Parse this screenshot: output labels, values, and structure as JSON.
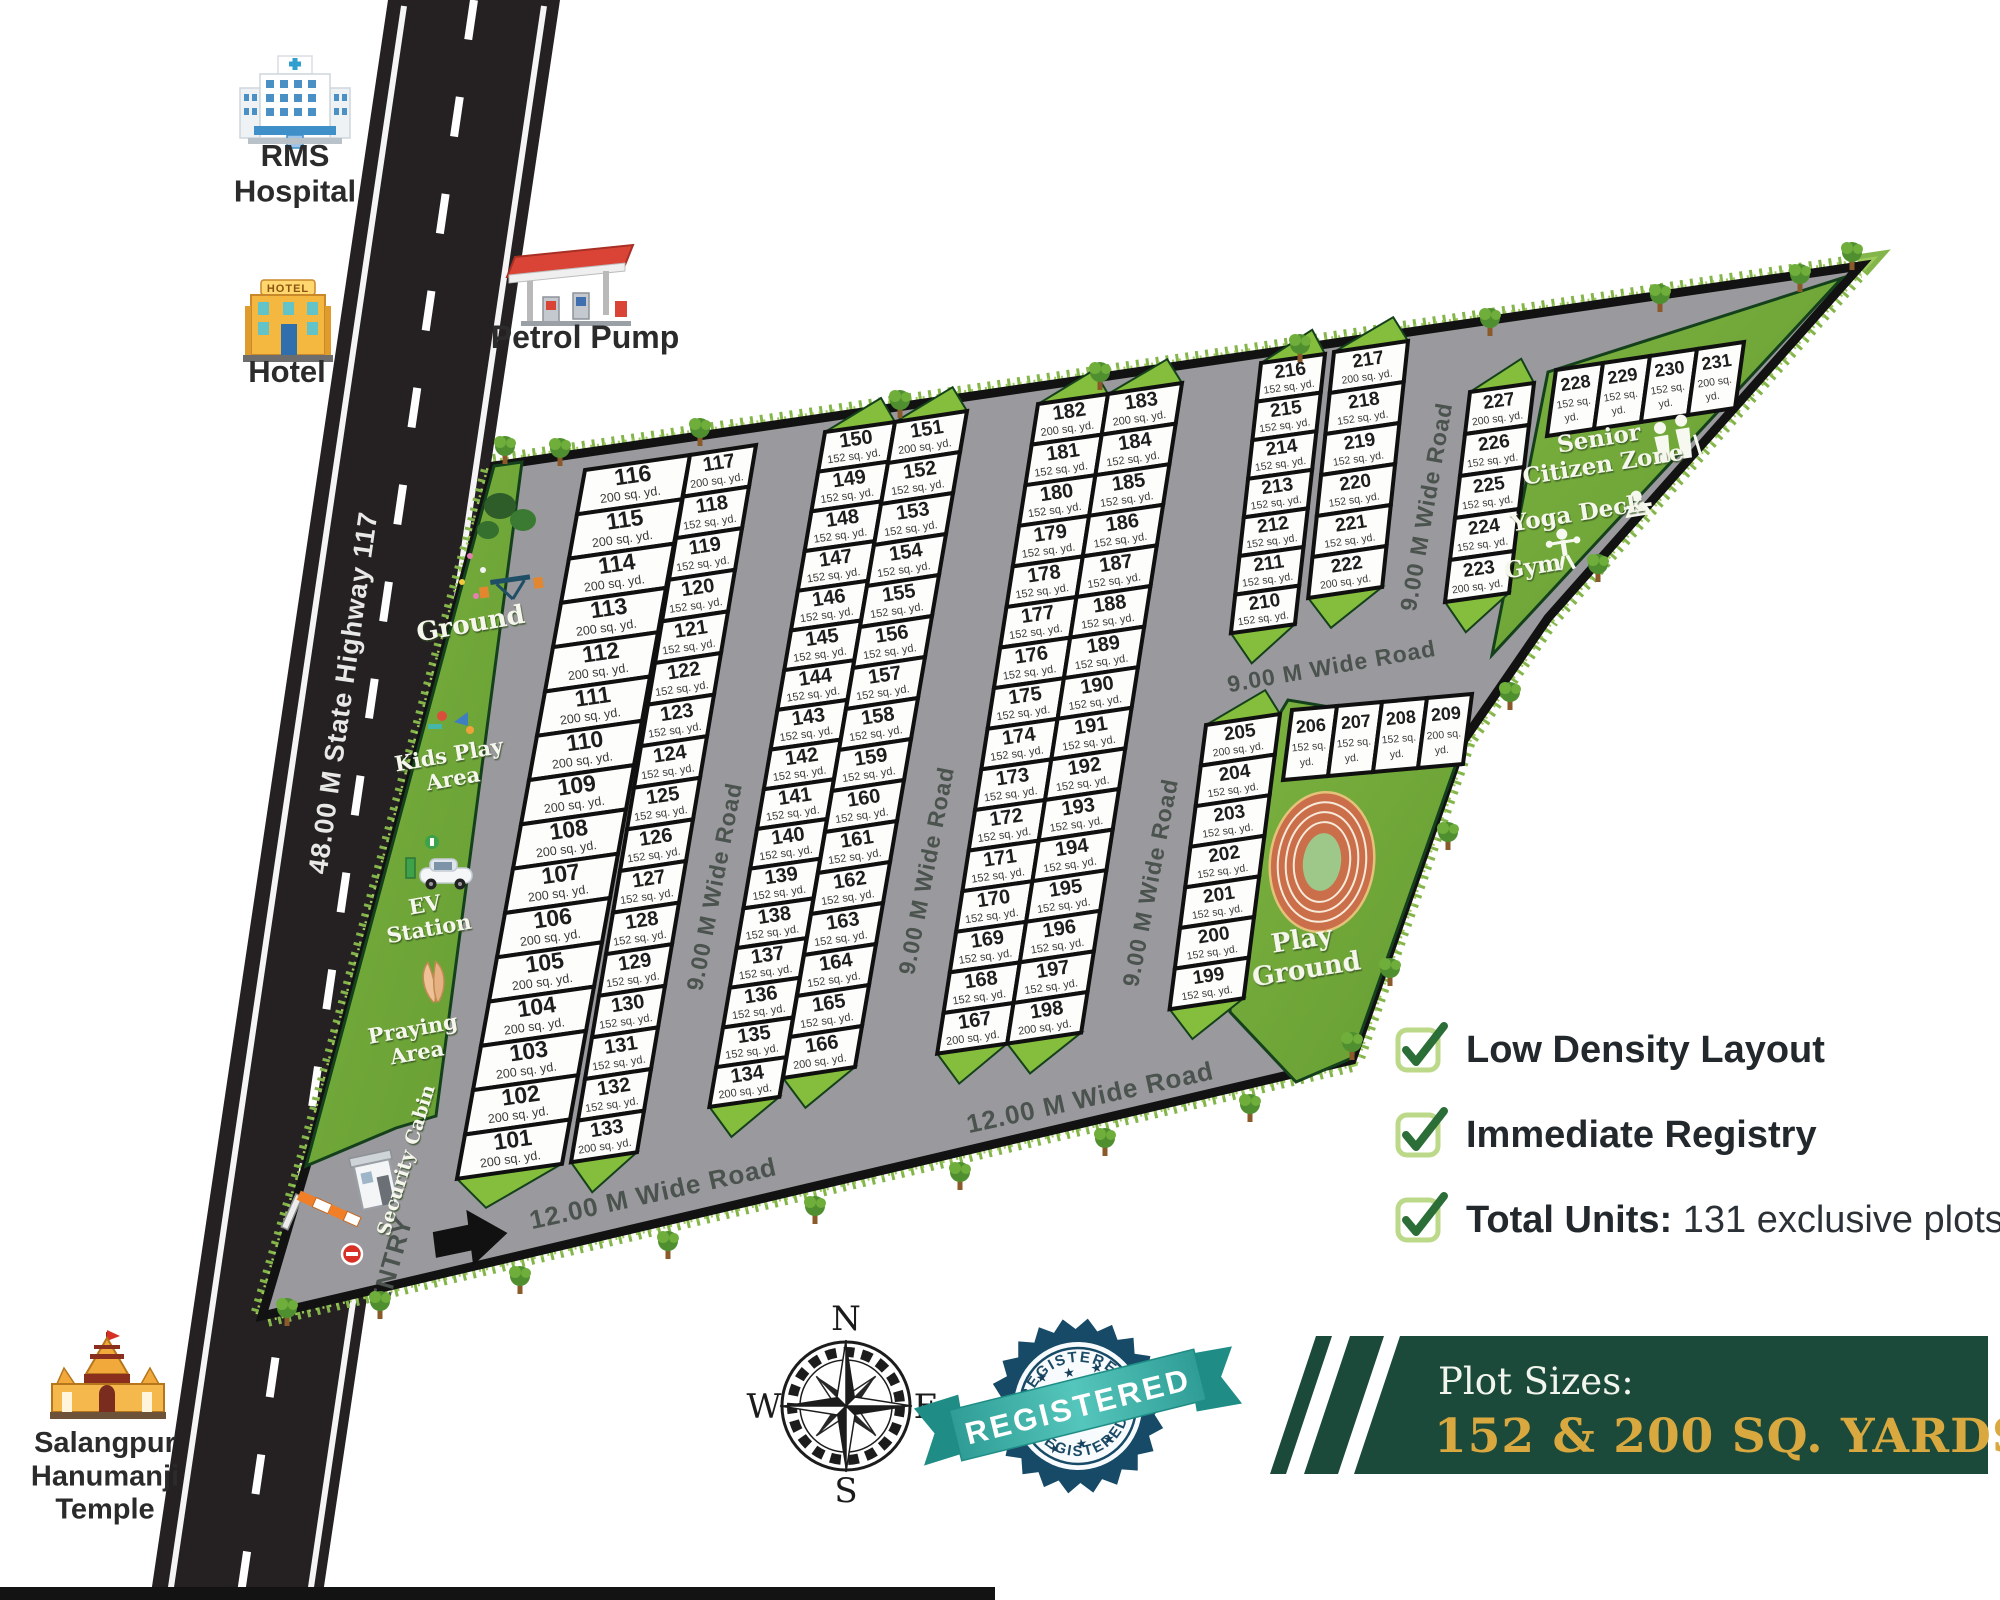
{
  "site": {
    "highway_label": "48.00 M State Highway 117",
    "entry_label": "ENTRY"
  },
  "roads": {
    "nine": "9.00 M Wide Road",
    "twelve": "12.00 M Wide Road"
  },
  "landmarks": {
    "hospital": {
      "lines": [
        "RMS",
        "Hospital"
      ]
    },
    "hotel": {
      "lines": [
        "Hotel"
      ],
      "sign": "HOTEL"
    },
    "petrol": {
      "lines": [
        "Petrol Pump"
      ]
    },
    "temple": {
      "lines": [
        "Salangpur",
        "Hanumanji",
        "Temple"
      ]
    }
  },
  "amenities": {
    "ground": {
      "lines": [
        "Ground"
      ]
    },
    "kids_play": {
      "lines": [
        "Kids Play",
        "Area"
      ]
    },
    "ev_station": {
      "lines": [
        "EV",
        "Station"
      ]
    },
    "praying": {
      "lines": [
        "Praying",
        "Area"
      ]
    },
    "security_cabin": {
      "lines": [
        "Security Cabin"
      ]
    },
    "senior_zone": {
      "lines": [
        "Senior",
        "Citizen Zone"
      ]
    },
    "yoga": {
      "lines": [
        "Yoga Deck"
      ]
    },
    "gym": {
      "lines": [
        "Gym"
      ]
    },
    "playground": {
      "lines": [
        "Play",
        "Ground"
      ]
    }
  },
  "features": [
    {
      "label": "Low Density Layout"
    },
    {
      "label": "Immediate Registry"
    },
    {
      "bold": "Total Units:",
      "rest": " 131 exclusive plots"
    }
  ],
  "banner": {
    "title": "Plot Sizes:",
    "sizes": "152 & 200 SQ. YARDS"
  },
  "badge": {
    "word": "REGISTERED",
    "stars": "★ ★ ★"
  },
  "compass": {
    "n": "N",
    "e": "E",
    "s": "S",
    "w": "W"
  },
  "plots": {
    "size_suffix": "sq. yd.",
    "groups": [
      {
        "id": "b1a",
        "items": [
          [
            "116",
            "200"
          ],
          [
            "115",
            "200"
          ],
          [
            "114",
            "200"
          ],
          [
            "113",
            "200"
          ],
          [
            "112",
            "200"
          ],
          [
            "111",
            "200"
          ],
          [
            "110",
            "200"
          ],
          [
            "109",
            "200"
          ],
          [
            "108",
            "200"
          ],
          [
            "107",
            "200"
          ],
          [
            "106",
            "200"
          ],
          [
            "105",
            "200"
          ],
          [
            "104",
            "200"
          ],
          [
            "103",
            "200"
          ],
          [
            "102",
            "200"
          ],
          [
            "101",
            "200"
          ]
        ]
      },
      {
        "id": "b1b",
        "items": [
          [
            "117",
            "200"
          ],
          [
            "118",
            "152"
          ],
          [
            "119",
            "152"
          ],
          [
            "120",
            "152"
          ],
          [
            "121",
            "152"
          ],
          [
            "122",
            "152"
          ],
          [
            "123",
            "152"
          ],
          [
            "124",
            "152"
          ],
          [
            "125",
            "152"
          ],
          [
            "126",
            "152"
          ],
          [
            "127",
            "152"
          ],
          [
            "128",
            "152"
          ],
          [
            "129",
            "152"
          ],
          [
            "130",
            "152"
          ],
          [
            "131",
            "152"
          ],
          [
            "132",
            "152"
          ],
          [
            "133",
            "200"
          ]
        ]
      },
      {
        "id": "b2a",
        "items": [
          [
            "150",
            "152"
          ],
          [
            "149",
            "152"
          ],
          [
            "148",
            "152"
          ],
          [
            "147",
            "152"
          ],
          [
            "146",
            "152"
          ],
          [
            "145",
            "152"
          ],
          [
            "144",
            "152"
          ],
          [
            "143",
            "152"
          ],
          [
            "142",
            "152"
          ],
          [
            "141",
            "152"
          ],
          [
            "140",
            "152"
          ],
          [
            "139",
            "152"
          ],
          [
            "138",
            "152"
          ],
          [
            "137",
            "152"
          ],
          [
            "136",
            "152"
          ],
          [
            "135",
            "152"
          ],
          [
            "134",
            "200"
          ]
        ]
      },
      {
        "id": "b2b",
        "items": [
          [
            "151",
            "200"
          ],
          [
            "152",
            "152"
          ],
          [
            "153",
            "152"
          ],
          [
            "154",
            "152"
          ],
          [
            "155",
            "152"
          ],
          [
            "156",
            "152"
          ],
          [
            "157",
            "152"
          ],
          [
            "158",
            "152"
          ],
          [
            "159",
            "152"
          ],
          [
            "160",
            "152"
          ],
          [
            "161",
            "152"
          ],
          [
            "162",
            "152"
          ],
          [
            "163",
            "152"
          ],
          [
            "164",
            "152"
          ],
          [
            "165",
            "152"
          ],
          [
            "166",
            "200"
          ]
        ]
      },
      {
        "id": "b3a",
        "items": [
          [
            "182",
            "200"
          ],
          [
            "181",
            "152"
          ],
          [
            "180",
            "152"
          ],
          [
            "179",
            "152"
          ],
          [
            "178",
            "152"
          ],
          [
            "177",
            "152"
          ],
          [
            "176",
            "152"
          ],
          [
            "175",
            "152"
          ],
          [
            "174",
            "152"
          ],
          [
            "173",
            "152"
          ],
          [
            "172",
            "152"
          ],
          [
            "171",
            "152"
          ],
          [
            "170",
            "152"
          ],
          [
            "169",
            "152"
          ],
          [
            "168",
            "152"
          ],
          [
            "167",
            "200"
          ]
        ]
      },
      {
        "id": "b3b",
        "items": [
          [
            "183",
            "200"
          ],
          [
            "184",
            "152"
          ],
          [
            "185",
            "152"
          ],
          [
            "186",
            "152"
          ],
          [
            "187",
            "152"
          ],
          [
            "188",
            "152"
          ],
          [
            "189",
            "152"
          ],
          [
            "190",
            "152"
          ],
          [
            "191",
            "152"
          ],
          [
            "192",
            "152"
          ],
          [
            "193",
            "152"
          ],
          [
            "194",
            "152"
          ],
          [
            "195",
            "152"
          ],
          [
            "196",
            "152"
          ],
          [
            "197",
            "152"
          ],
          [
            "198",
            "200"
          ]
        ]
      },
      {
        "id": "b4a",
        "items": [
          [
            "216",
            "152"
          ],
          [
            "215",
            "152"
          ],
          [
            "214",
            "152"
          ],
          [
            "213",
            "152"
          ],
          [
            "212",
            "152"
          ],
          [
            "211",
            "152"
          ],
          [
            "210",
            "152"
          ]
        ]
      },
      {
        "id": "b4b",
        "items": [
          [
            "217",
            "200"
          ],
          [
            "218",
            "152"
          ],
          [
            "219",
            "152"
          ],
          [
            "220",
            "152"
          ],
          [
            "221",
            "152"
          ],
          [
            "222",
            "200"
          ]
        ]
      },
      {
        "id": "b4c",
        "items": [
          [
            "205",
            "200"
          ],
          [
            "204",
            "152"
          ],
          [
            "203",
            "152"
          ],
          [
            "202",
            "152"
          ],
          [
            "201",
            "152"
          ],
          [
            "200",
            "152"
          ],
          [
            "199",
            "152"
          ]
        ]
      },
      {
        "id": "r206",
        "items": [
          [
            "206",
            "152"
          ],
          [
            "207",
            "152"
          ],
          [
            "208",
            "152"
          ],
          [
            "209",
            "200"
          ]
        ]
      },
      {
        "id": "b5",
        "items": [
          [
            "227",
            "200"
          ],
          [
            "226",
            "152"
          ],
          [
            "225",
            "152"
          ],
          [
            "224",
            "152"
          ],
          [
            "223",
            "200"
          ]
        ]
      },
      {
        "id": "r228",
        "items": [
          [
            "228",
            "152"
          ],
          [
            "229",
            "152"
          ],
          [
            "230",
            "152"
          ],
          [
            "231",
            "200"
          ]
        ]
      }
    ]
  },
  "colors": {
    "road_gray": "#9a999d",
    "highway": "#252122",
    "grass_dark": "#659c33",
    "grass_light": "#7cb23f",
    "wedge_green": "#85bd3c",
    "banner_green": "#1c4a3a",
    "banner_gold": "#d9a93f",
    "badge_navy": "#174a67",
    "badge_teal": "#3fb3ab",
    "check_green": "#2c6e38"
  }
}
